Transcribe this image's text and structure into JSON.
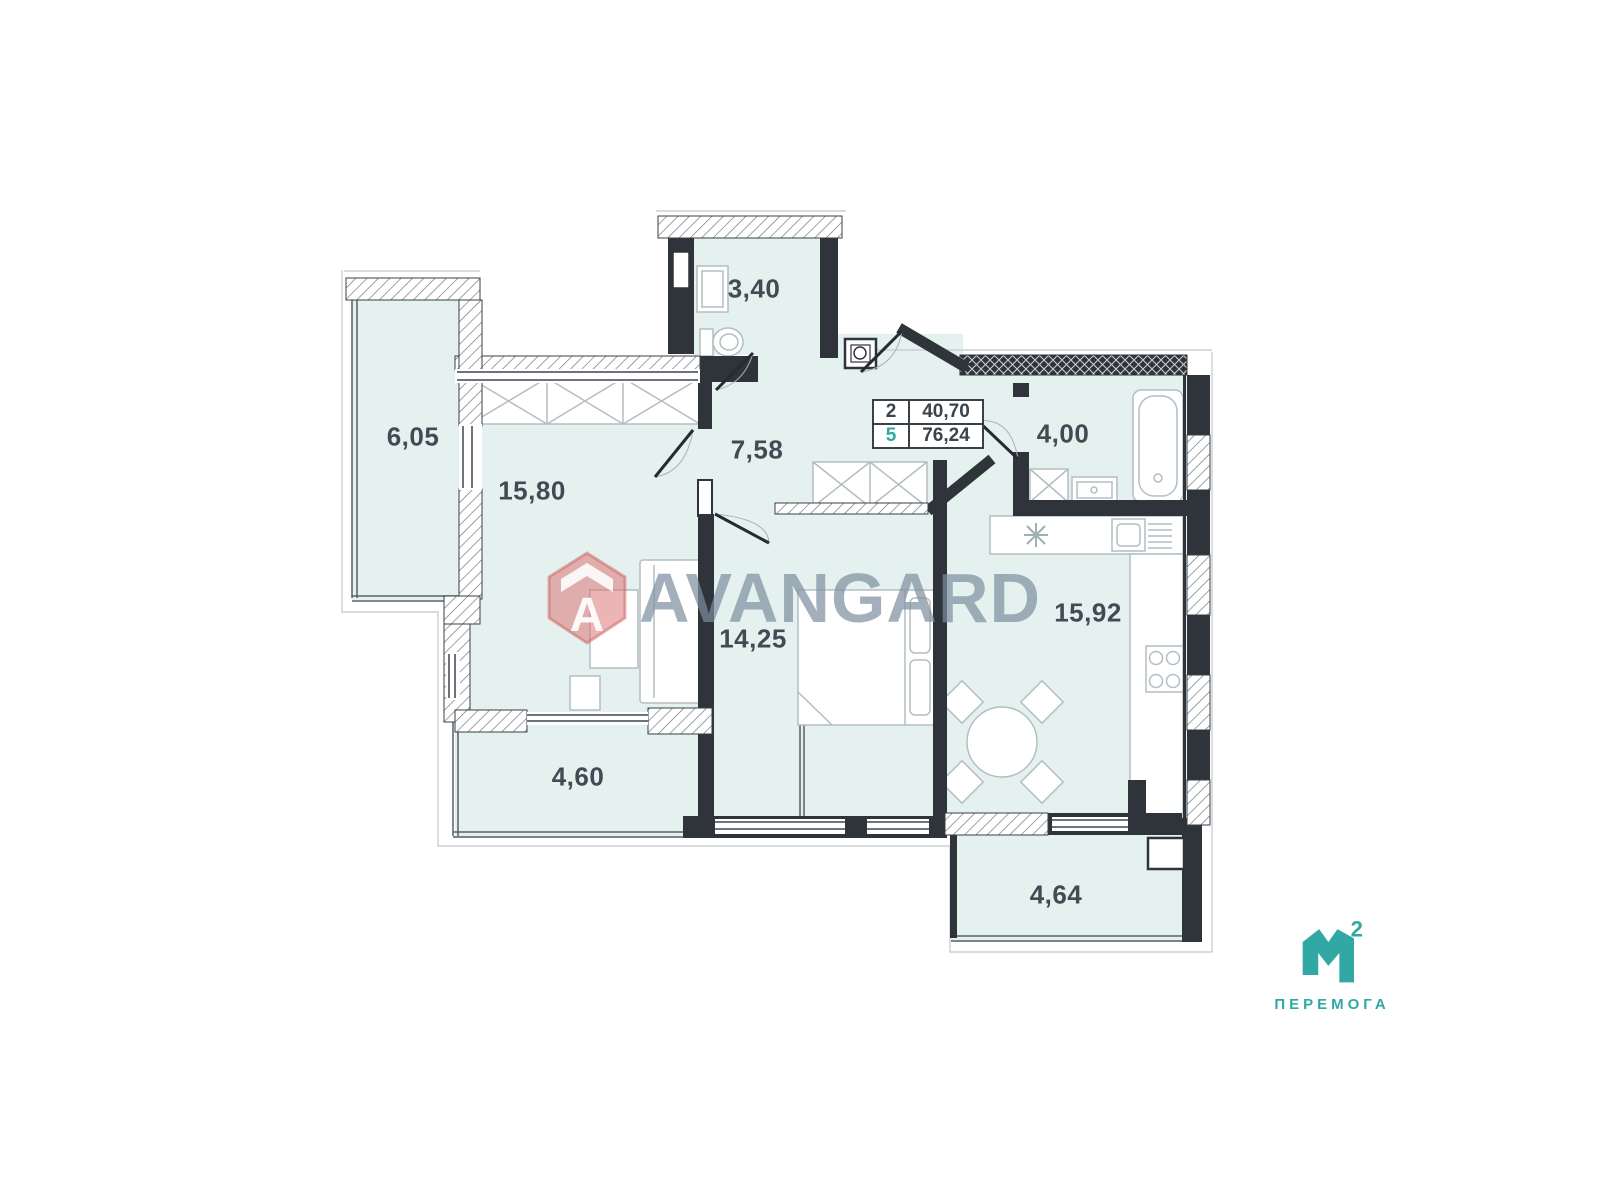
{
  "plan": {
    "rooms": [
      {
        "name": "balcony-left",
        "area": "6,05"
      },
      {
        "name": "living-room",
        "area": "15,80"
      },
      {
        "name": "hallway",
        "area": "7,58"
      },
      {
        "name": "wc",
        "area": "3,40"
      },
      {
        "name": "bathroom",
        "area": "4,00"
      },
      {
        "name": "kitchen",
        "area": "15,92"
      },
      {
        "name": "bedroom",
        "area": "14,25"
      },
      {
        "name": "balcony-bottom-left",
        "area": "4,60"
      },
      {
        "name": "balcony-bottom-right",
        "area": "4,64"
      }
    ],
    "info_table": {
      "rows": [
        {
          "label": "2",
          "value": "40,70"
        },
        {
          "label": "5",
          "value": "76,24"
        }
      ]
    }
  },
  "watermark": {
    "brand": "AVANGARD",
    "icon_letter": "A"
  },
  "developer_logo": {
    "mark_letter": "М",
    "mark_sup": "2",
    "name": "ПЕРЕМОГА"
  },
  "colors": {
    "room_fill": "#e4f1ee",
    "wall": "#2f343a",
    "accent_teal": "#2fa7a2",
    "watermark_text": "#7c8ea0",
    "watermark_icon": "#d96a6a",
    "label_text": "#424b54"
  }
}
